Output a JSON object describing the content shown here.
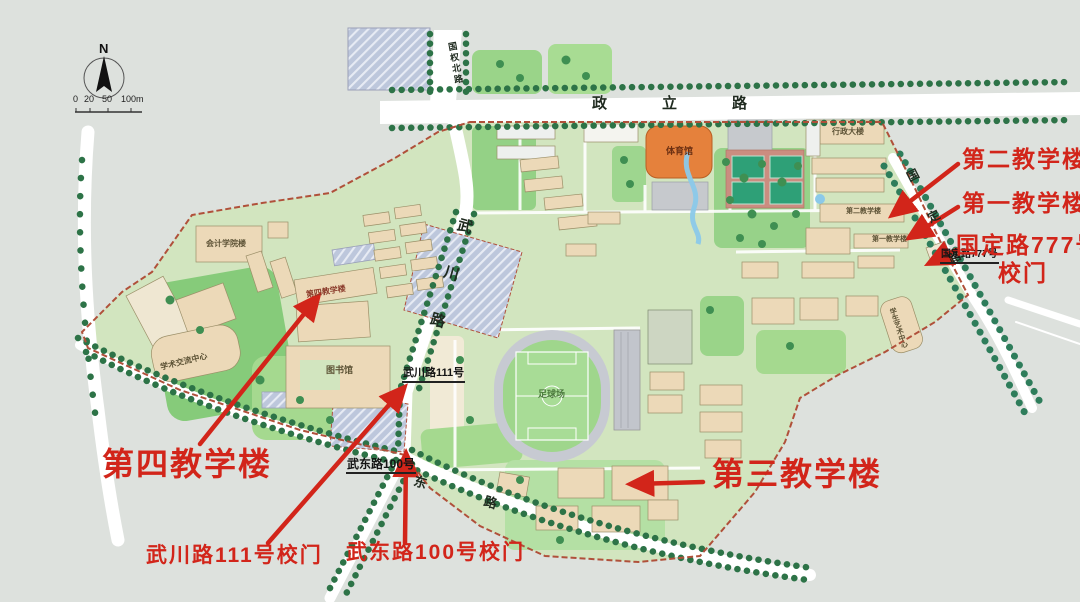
{
  "annotations": {
    "teach2_big": "第二教学楼",
    "teach1_big": "第一教学楼",
    "gate777_line1": "国定路777号",
    "gate777_line2": "校门",
    "teach4_big": "第四教学楼",
    "teach3_big": "第三教学楼",
    "gate_wuchuan_big": "武川路111号校门",
    "gate_wudong_big": "武东路100号校门"
  },
  "map_text": {
    "road_zhengli": "政立路",
    "road_guoquanbei": "国权北路",
    "road_wuchuan": "武川路",
    "road_wudong": "东路",
    "road_guoding": "国定路",
    "gate_wuchuan": "武川路111号",
    "gate_wudong": "武东路100号",
    "gate_guoding": "国定路777号",
    "bldg_gym": "体育馆",
    "bldg_admin": "行政大楼",
    "bldg_accounting": "会计学院楼",
    "bldg_exchange": "学术交流中心",
    "bldg_library": "图书馆",
    "bldg_football": "足球场",
    "bldg_art": "学生艺术中心",
    "bldg_teach2": "第二教学楼",
    "bldg_teach1": "第一教学楼",
    "bldg_teach4": "第四教学楼"
  },
  "compass": {
    "north": "N"
  },
  "scale": {
    "ticks": [
      "0",
      "20",
      "50",
      "100m"
    ]
  },
  "colors": {
    "annotation_red": "#d2251a",
    "boundary_red": "#b0503a",
    "campus_green": "#d2e5bf",
    "gym_orange": "#e5813c",
    "background": "#dde1dd"
  }
}
